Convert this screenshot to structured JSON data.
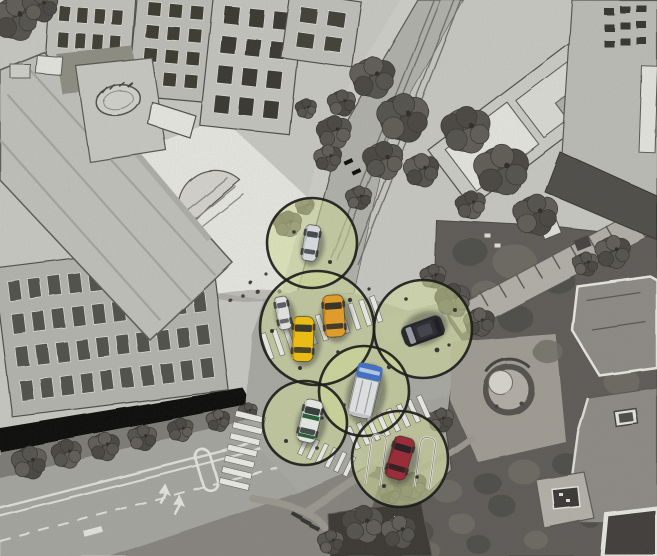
{
  "meta": {
    "kind": "aerial-sketch-illustration",
    "subject": "urban-intersection-with-vehicle-communication-ranges",
    "canvas": {
      "width": 657,
      "height": 556
    }
  },
  "palette": {
    "paper": "#cfcfca",
    "road": "#b0b0aa",
    "avenue": "#a9a9a4",
    "intersection": "#adada7",
    "plaza": "#f1f1ec",
    "sidewalk": "#ececе6",
    "park_dark": "#5c5954",
    "range_fill": "#dcea9e",
    "range_fill_opacity": 0.55,
    "range_stroke": "#0e0e0c",
    "crosswalk_stripe": "#f6f6f0"
  },
  "scene": {
    "ranges": [
      {
        "id": "range-white-sedan",
        "cx": 312,
        "cy": 243,
        "r": 45
      },
      {
        "id": "range-taxis",
        "cx": 317,
        "cy": 328,
        "r": 57
      },
      {
        "id": "range-black-suv",
        "cx": 423,
        "cy": 329,
        "r": 49
      },
      {
        "id": "range-blue-white-van",
        "cx": 364,
        "cy": 391,
        "r": 45
      },
      {
        "id": "range-green-stripe-car",
        "cx": 305,
        "cy": 423,
        "r": 42
      },
      {
        "id": "range-red-car",
        "cx": 400,
        "cy": 459,
        "r": 48
      }
    ],
    "vehicles": [
      {
        "id": "parked-white-van",
        "kind": "plain",
        "x": 283,
        "y": 313,
        "rot": -10,
        "w": 13,
        "l": 33,
        "body": "#f0f0ee",
        "shade": "#c9c9c4",
        "glass": "#565b60"
      },
      {
        "id": "white-sedan",
        "kind": "sedan",
        "x": 311,
        "y": 243,
        "rot": 9,
        "w": 15,
        "l": 36,
        "body": "#e4e7ea",
        "shade": "#b9bcc0",
        "glass": "#3e444c"
      },
      {
        "id": "orange-taxi",
        "kind": "sedan",
        "x": 334,
        "y": 316,
        "rot": -4,
        "w": 21,
        "l": 42,
        "body": "#f0a21f",
        "shade": "#c77f12",
        "glass": "#2e2a20"
      },
      {
        "id": "yellow-taxi",
        "kind": "sedan",
        "x": 303,
        "y": 339,
        "rot": 2,
        "w": 21,
        "l": 45,
        "body": "#fdc705",
        "shade": "#d09d04",
        "glass": "#33301f"
      },
      {
        "id": "black-suv",
        "kind": "suv",
        "x": 423,
        "y": 331,
        "rot": -110,
        "w": 21,
        "l": 42,
        "body": "#1b1b24",
        "shade": "#101018",
        "glass": "#9aa0a8"
      },
      {
        "id": "blue-white-van",
        "kind": "boxvan",
        "x": 365,
        "y": 391,
        "rot": 13,
        "w": 25,
        "l": 54,
        "body": "#eceef0",
        "shade": "#c9ccd0",
        "glass": "#bcd2ee",
        "cab": "#3a6fd2"
      },
      {
        "id": "green-stripe-car",
        "kind": "sedan",
        "x": 310,
        "y": 421,
        "rot": 13,
        "w": 19,
        "l": 43,
        "body": "#f3f5f1",
        "shade": "#cfd4cd",
        "glass": "#2c3833",
        "accent": "#1e5c33"
      },
      {
        "id": "red-car",
        "kind": "sedan",
        "x": 400,
        "y": 458,
        "rot": 16,
        "w": 21,
        "l": 43,
        "body": "#9e2130",
        "shade": "#7c1824",
        "glass": "#201418"
      }
    ],
    "crosswalks": [
      {
        "id": "crosswalk-west-avenue",
        "x1": 251,
        "y1": 414,
        "x2": 233,
        "y2": 489,
        "w": 30,
        "bar": 6,
        "gap": 5.5
      },
      {
        "id": "crosswalk-north-wide",
        "x1": 265,
        "y1": 347,
        "x2": 385,
        "y2": 306,
        "w": 27,
        "bar": 5,
        "gap": 6.5
      },
      {
        "id": "crosswalk-east-leg",
        "x1": 351,
        "y1": 439,
        "x2": 434,
        "y2": 402,
        "w": 24,
        "bar": 5,
        "gap": 6
      },
      {
        "id": "crosswalk-south-leg",
        "x1": 302,
        "y1": 444,
        "x2": 357,
        "y2": 470,
        "w": 21,
        "bar": 4.5,
        "gap": 5.5
      }
    ],
    "parking_rails": {
      "rotate": [
        8,
        400,
        460
      ],
      "paths": [
        "M369,488 L369,446 Q369,438 375,438 L378,438 Q384,438 384,446 L384,488",
        "M418,484 L418,442 Q418,434 424,434 L427,434 Q433,434 433,442 L433,484"
      ]
    },
    "debris_dots": [
      [
        330,
        262,
        2
      ],
      [
        294,
        232,
        1.8
      ],
      [
        350,
        300,
        2.2
      ],
      [
        300,
        368,
        2
      ],
      [
        338,
        352,
        1.8
      ],
      [
        272,
        331,
        2
      ],
      [
        437,
        350,
        2.4
      ],
      [
        455,
        310,
        2
      ],
      [
        389,
        367,
        2.2
      ],
      [
        344,
        405,
        1.8
      ],
      [
        286,
        441,
        2
      ],
      [
        317,
        448,
        1.8
      ],
      [
        384,
        486,
        2
      ],
      [
        417,
        477,
        1.8
      ],
      [
        369,
        289,
        1.6
      ],
      [
        406,
        299,
        1.8
      ],
      [
        322,
        418,
        1.6
      ],
      [
        449,
        345,
        1.6
      ]
    ],
    "background": {
      "buildings": [
        {
          "id": "block-a",
          "x": 50,
          "y": -8,
          "w": 86,
          "h": 68,
          "rot": 4,
          "wall": "#c8c8c3",
          "win": "#38382f",
          "cols": 4,
          "rows": 2
        },
        {
          "id": "block-b",
          "x": 138,
          "y": -12,
          "w": 80,
          "h": 108,
          "rot": 5,
          "wall": "#c3c3be",
          "win": "#34342c",
          "cols": 3,
          "rows": 4
        },
        {
          "id": "block-c",
          "x": 214,
          "y": -10,
          "w": 90,
          "h": 136,
          "rot": 6,
          "wall": "#cbcbc6",
          "win": "#31312a",
          "cols": 3,
          "rows": 4
        },
        {
          "id": "block-d",
          "x": 290,
          "y": -8,
          "w": 72,
          "h": 66,
          "rot": 8,
          "wall": "#c6c6c1",
          "win": "#3a3a32",
          "cols": 2,
          "rows": 2
        },
        {
          "id": "rooftop-block",
          "x": 428,
          "y": 150,
          "w": 205,
          "h": 72,
          "rot": -37,
          "wall": "#d3d3ce",
          "win": null,
          "cols": 0,
          "rows": 0,
          "panels": [
            [
              14,
              10,
              78,
              52,
              "#efefe9"
            ],
            [
              100,
              14,
              72,
              46,
              "#e3e3dd"
            ],
            [
              34,
              44,
              30,
              20,
              "#bdbdb7"
            ],
            [
              130,
              40,
              26,
              16,
              "#b4b4ae"
            ]
          ]
        },
        {
          "id": "glass-building",
          "x": -6,
          "y": 268,
          "w": 218,
          "h": 150,
          "rot": -7,
          "wall": "#b9b9b3",
          "win": "#4d4d47",
          "cols": 10,
          "rows": 4
        }
      ],
      "tree_clusters": [
        [
          14,
          18,
          20
        ],
        [
          40,
          6,
          15
        ],
        [
          333,
          132,
          15
        ],
        [
          327,
          158,
          12
        ],
        [
          341,
          103,
          12
        ],
        [
          305,
          108,
          9
        ],
        [
          372,
          78,
          19
        ],
        [
          402,
          118,
          22
        ],
        [
          382,
          160,
          17
        ],
        [
          420,
          170,
          15
        ],
        [
          358,
          198,
          11
        ],
        [
          465,
          130,
          21
        ],
        [
          500,
          170,
          23
        ],
        [
          535,
          215,
          19
        ],
        [
          470,
          205,
          13
        ],
        [
          612,
          252,
          15
        ],
        [
          585,
          264,
          11
        ],
        [
          452,
          300,
          15
        ],
        [
          478,
          322,
          13
        ],
        [
          432,
          276,
          11
        ],
        [
          287,
          224,
          12
        ],
        [
          304,
          206,
          8
        ],
        [
          28,
          462,
          15
        ],
        [
          66,
          454,
          13
        ],
        [
          104,
          447,
          13
        ],
        [
          142,
          438,
          12
        ],
        [
          180,
          430,
          11
        ],
        [
          218,
          421,
          10
        ],
        [
          248,
          412,
          8
        ],
        [
          362,
          524,
          17
        ],
        [
          398,
          532,
          15
        ],
        [
          330,
          542,
          11
        ],
        [
          412,
          486,
          12
        ],
        [
          390,
          494,
          9
        ],
        [
          440,
          420,
          11
        ]
      ],
      "park_mottle": [
        [
          470,
          252,
          18,
          0
        ],
        [
          515,
          262,
          22,
          1
        ],
        [
          558,
          280,
          17,
          0
        ],
        [
          598,
          302,
          20,
          1
        ],
        [
          632,
          334,
          16,
          0
        ],
        [
          486,
          292,
          14,
          1
        ],
        [
          515,
          318,
          18,
          0
        ],
        [
          548,
          352,
          15,
          1
        ],
        [
          592,
          342,
          14,
          0
        ],
        [
          622,
          382,
          18,
          1
        ],
        [
          638,
          424,
          14,
          0
        ],
        [
          604,
          446,
          16,
          1
        ],
        [
          566,
          464,
          14,
          0
        ],
        [
          524,
          472,
          16,
          1
        ],
        [
          488,
          484,
          14,
          0
        ],
        [
          448,
          492,
          15,
          1
        ],
        [
          408,
          492,
          13,
          0
        ],
        [
          382,
          520,
          16,
          1
        ],
        [
          420,
          532,
          14,
          0
        ],
        [
          462,
          524,
          13,
          1
        ],
        [
          502,
          506,
          14,
          0
        ],
        [
          556,
          508,
          12,
          1
        ],
        [
          612,
          492,
          13,
          0
        ],
        [
          646,
          518,
          12,
          1
        ],
        [
          590,
          520,
          10,
          0
        ],
        [
          536,
          540,
          12,
          1
        ],
        [
          478,
          544,
          12,
          0
        ],
        [
          430,
          550,
          10,
          1
        ]
      ]
    }
  }
}
